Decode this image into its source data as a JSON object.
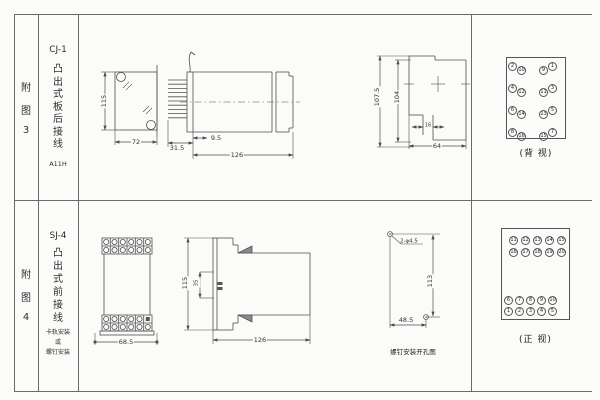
{
  "figures": [
    {
      "index_chars": [
        "附",
        "图",
        "3"
      ],
      "model": "CJ-1",
      "mount_chars": [
        "凸",
        "出",
        "式",
        "板",
        "后",
        "接",
        "线"
      ],
      "code": "A11H",
      "dims": {
        "height": "115",
        "width": "72",
        "pin_len": "31.5",
        "pin_offset": "9.5",
        "length": "126",
        "panel_total": "107.5",
        "panel_cut": "104",
        "notch": "16",
        "depth": "64"
      },
      "terminals": {
        "caption": "(背 视)",
        "left_outer": [
          "2",
          "4",
          "6",
          "8"
        ],
        "left_inner": [
          "10",
          "12",
          "14",
          "16"
        ],
        "right_inner": [
          "9",
          "11",
          "13",
          "15"
        ],
        "right_outer": [
          "1",
          "3",
          "5",
          "7"
        ]
      }
    },
    {
      "index_chars": [
        "附",
        "图",
        "4"
      ],
      "model": "SJ-4",
      "mount_chars": [
        "凸",
        "出",
        "式",
        "前",
        "接",
        "线"
      ],
      "mount_notes": [
        "卡轨安装",
        "或",
        "螺钉安装"
      ],
      "dims": {
        "width": "68.5",
        "height": "115",
        "rail": "35",
        "length": "126",
        "hole_note": "2-φ4.5",
        "hole_v": "113",
        "hole_h": "48.5"
      },
      "hole_caption": "螺钉安装开孔图",
      "terminals": {
        "caption": "(正 视)",
        "rows_top": [
          [
            "11",
            "12",
            "13",
            "14",
            "15"
          ],
          [
            "16",
            "17",
            "18",
            "19",
            "20"
          ]
        ],
        "rows_bottom": [
          [
            "6",
            "7",
            "8",
            "9",
            "10"
          ],
          [
            "1",
            "2",
            "3",
            "4",
            "5"
          ]
        ]
      }
    }
  ]
}
